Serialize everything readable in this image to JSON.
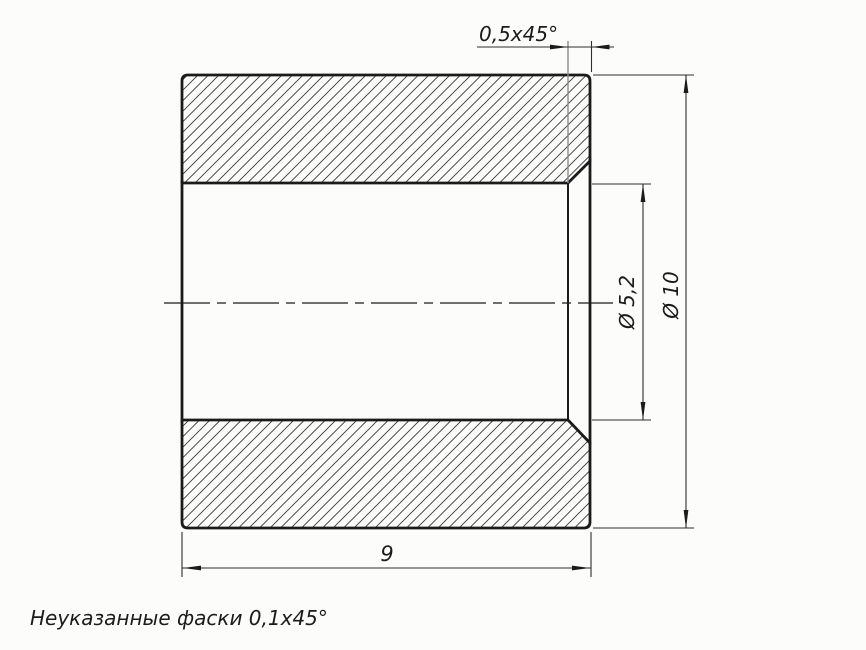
{
  "drawing": {
    "view": "section-view-of-bushing",
    "note": "Неуказанные фаски 0,1x45°",
    "dimensions": {
      "chamfer": {
        "label": "0,5x45°",
        "value_mm": 0.5,
        "angle_deg": 45
      },
      "inner_diameter": {
        "label": "Ø 5,2",
        "value_mm": 5.2
      },
      "outer_diameter": {
        "label": "Ø 10",
        "value_mm": 10
      },
      "length": {
        "label": "9",
        "value_mm": 9
      },
      "default_chamfer": {
        "value_mm": 0.1,
        "angle_deg": 45
      }
    },
    "colors": {
      "background": "#fcfcfb",
      "outline": "#1b1b1b",
      "thin_line": "#2e2e2e",
      "gray_extension": "#8d8d8d"
    }
  }
}
